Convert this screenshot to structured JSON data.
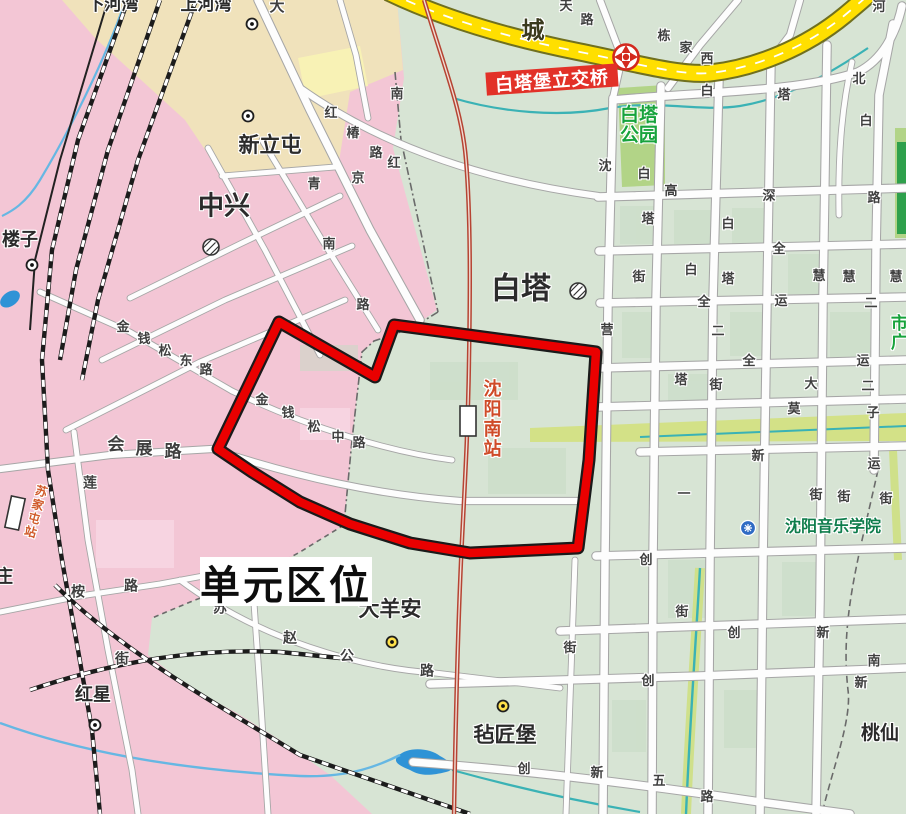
{
  "map_title": "单元区位",
  "unit_title": {
    "text": "单元区位"
  },
  "interchange_label": {
    "text": "白塔堡立交桥"
  },
  "colors": {
    "unit_boundary_red": "#ea0000",
    "boundary_casing": "#1a1a1a",
    "urban_pink": "#f3c6d5",
    "village_cream": "#f0e2bb",
    "pale_yellow_block": "#f8f2b5",
    "base_green": "#d7e4d4",
    "park_green": "#b2d487",
    "greenway": "#d3e187",
    "highway_yellow": "#ffdf00",
    "road_white": "#fdfdfd",
    "water_blue": "#2f93d6",
    "stream_blue": "#66b7e3",
    "canal_teal": "#3ab2b5",
    "railway_black": "#1c1c1c",
    "hsr_red": "#b64433",
    "station_text_red": "#cf4b28",
    "green_text": "#17a33c",
    "sign_red_bg": "#e23128"
  },
  "icons": [
    {
      "name": "interchange-icon",
      "meaning": "highway interchange (red pinwheel)"
    },
    {
      "name": "town-circle-icon",
      "meaning": "town/subdistrict hatched circle"
    },
    {
      "name": "village-dot-white-icon",
      "meaning": "village marker (white dot)"
    },
    {
      "name": "village-dot-yellow-icon",
      "meaning": "village marker (yellow dot)"
    },
    {
      "name": "college-icon",
      "meaning": "college/university marker (blue badge)"
    },
    {
      "name": "station-rect-icon",
      "meaning": "railway station"
    }
  ],
  "stations": [
    {
      "label": "沈阳南站"
    },
    {
      "label": "苏家屯站"
    }
  ],
  "labels": [
    {
      "t": "下河湾",
      "x": 113,
      "y": 5,
      "s": 17,
      "b": 1,
      "n": "place-label"
    },
    {
      "t": "上河湾",
      "x": 206,
      "y": 5,
      "s": 17,
      "b": 1,
      "n": "place-label"
    },
    {
      "t": "大",
      "x": 277,
      "y": 7,
      "s": 15,
      "n": "road-char"
    },
    {
      "t": "城",
      "x": 533,
      "y": 30,
      "s": 23,
      "b": 1,
      "c": "#3a3a1e",
      "n": "road-char"
    },
    {
      "t": "天",
      "x": 566,
      "y": 6,
      "n": "road-char"
    },
    {
      "t": "路",
      "x": 587,
      "y": 20,
      "n": "road-char"
    },
    {
      "t": "栋",
      "x": 664,
      "y": 36,
      "n": "road-char"
    },
    {
      "t": "家",
      "x": 686,
      "y": 48,
      "n": "road-char"
    },
    {
      "t": "西",
      "x": 707,
      "y": 59,
      "n": "road-char"
    },
    {
      "t": "河",
      "x": 879,
      "y": 7,
      "n": "road-char"
    },
    {
      "t": "白",
      "x": 707,
      "y": 91,
      "n": "road-char"
    },
    {
      "t": "塔",
      "x": 784,
      "y": 95,
      "n": "road-char"
    },
    {
      "t": "北",
      "x": 859,
      "y": 79,
      "n": "road-char"
    },
    {
      "t": "白",
      "x": 866,
      "y": 121,
      "n": "road-char"
    },
    {
      "t": "南",
      "x": 397,
      "y": 94,
      "n": "road-char"
    },
    {
      "t": "新立屯",
      "x": 270,
      "y": 146,
      "s": 21,
      "b": 1,
      "n": "place-label"
    },
    {
      "t": "红",
      "x": 331,
      "y": 113,
      "n": "road-char"
    },
    {
      "t": "椿",
      "x": 353,
      "y": 133,
      "n": "road-char"
    },
    {
      "t": "路",
      "x": 376,
      "y": 153,
      "n": "road-char"
    },
    {
      "t": "红",
      "x": 394,
      "y": 163,
      "n": "road-char"
    },
    {
      "t": "青",
      "x": 314,
      "y": 184,
      "n": "road-char"
    },
    {
      "t": "京",
      "x": 358,
      "y": 178,
      "n": "road-char"
    },
    {
      "t": "中兴",
      "x": 224,
      "y": 206,
      "s": 26,
      "b": 1,
      "n": "place-label"
    },
    {
      "t": "南",
      "x": 329,
      "y": 244,
      "n": "road-char"
    },
    {
      "t": "路",
      "x": 363,
      "y": 305,
      "n": "road-char"
    },
    {
      "t": "沈",
      "x": 605,
      "y": 166,
      "n": "road-char"
    },
    {
      "t": "白",
      "x": 644,
      "y": 174,
      "n": "road-char"
    },
    {
      "t": "高",
      "x": 671,
      "y": 191,
      "n": "road-char"
    },
    {
      "t": "深",
      "x": 769,
      "y": 196,
      "n": "road-char"
    },
    {
      "t": "路",
      "x": 874,
      "y": 198,
      "n": "road-char"
    },
    {
      "t": "塔",
      "x": 648,
      "y": 219,
      "n": "road-char"
    },
    {
      "t": "白",
      "x": 728,
      "y": 224,
      "n": "road-char"
    },
    {
      "t": "全",
      "x": 779,
      "y": 249,
      "n": "road-char"
    },
    {
      "t": "街",
      "x": 639,
      "y": 277,
      "n": "road-char"
    },
    {
      "t": "白",
      "x": 691,
      "y": 270,
      "n": "road-char"
    },
    {
      "t": "塔",
      "x": 728,
      "y": 279,
      "n": "road-char"
    },
    {
      "t": "慧",
      "x": 819,
      "y": 276,
      "n": "road-char"
    },
    {
      "t": "慧",
      "x": 849,
      "y": 277,
      "n": "road-char"
    },
    {
      "t": "慧",
      "x": 896,
      "y": 277,
      "n": "road-char"
    },
    {
      "t": "白塔",
      "x": 521,
      "y": 289,
      "s": 30,
      "b": 1,
      "n": "place-label"
    },
    {
      "t": "全",
      "x": 704,
      "y": 302,
      "n": "road-char"
    },
    {
      "t": "运",
      "x": 781,
      "y": 301,
      "n": "road-char"
    },
    {
      "t": "二",
      "x": 871,
      "y": 303,
      "n": "road-char"
    },
    {
      "t": "营",
      "x": 607,
      "y": 330,
      "n": "road-char"
    },
    {
      "t": "二",
      "x": 718,
      "y": 331,
      "n": "road-char"
    },
    {
      "t": "全",
      "x": 749,
      "y": 361,
      "n": "road-char"
    },
    {
      "t": "运",
      "x": 863,
      "y": 361,
      "n": "road-char"
    },
    {
      "t": "金",
      "x": 123,
      "y": 327,
      "n": "road-char"
    },
    {
      "t": "钱",
      "x": 144,
      "y": 339,
      "n": "road-char"
    },
    {
      "t": "松",
      "x": 165,
      "y": 351,
      "n": "road-char"
    },
    {
      "t": "东",
      "x": 186,
      "y": 361,
      "n": "road-char"
    },
    {
      "t": "路",
      "x": 206,
      "y": 370,
      "n": "road-char"
    },
    {
      "t": "塔",
      "x": 681,
      "y": 380,
      "n": "road-char"
    },
    {
      "t": "街",
      "x": 716,
      "y": 385,
      "n": "road-char"
    },
    {
      "t": "大",
      "x": 811,
      "y": 384,
      "n": "road-char"
    },
    {
      "t": "二",
      "x": 868,
      "y": 386,
      "n": "road-char"
    },
    {
      "t": "金",
      "x": 262,
      "y": 400,
      "n": "road-char"
    },
    {
      "t": "钱",
      "x": 288,
      "y": 413,
      "n": "road-char"
    },
    {
      "t": "松",
      "x": 314,
      "y": 427,
      "n": "road-char"
    },
    {
      "t": "中",
      "x": 338,
      "y": 437,
      "n": "road-char"
    },
    {
      "t": "路",
      "x": 359,
      "y": 443,
      "n": "road-char"
    },
    {
      "t": "莫",
      "x": 794,
      "y": 409,
      "n": "road-char"
    },
    {
      "t": "子",
      "x": 873,
      "y": 413,
      "n": "road-char"
    },
    {
      "t": "会",
      "x": 116,
      "y": 445,
      "s": 17,
      "b": 1,
      "n": "road-char"
    },
    {
      "t": "展",
      "x": 144,
      "y": 449,
      "s": 17,
      "b": 1,
      "n": "road-char"
    },
    {
      "t": "路",
      "x": 173,
      "y": 452,
      "s": 17,
      "b": 1,
      "n": "road-char"
    },
    {
      "t": "新",
      "x": 758,
      "y": 456,
      "n": "road-char"
    },
    {
      "t": "运",
      "x": 874,
      "y": 464,
      "n": "road-char"
    },
    {
      "t": "莲",
      "x": 90,
      "y": 483,
      "s": 14,
      "n": "road-char"
    },
    {
      "t": "一",
      "x": 684,
      "y": 494,
      "n": "road-char"
    },
    {
      "t": "街",
      "x": 816,
      "y": 495,
      "n": "road-char"
    },
    {
      "t": "街",
      "x": 844,
      "y": 497,
      "n": "road-char"
    },
    {
      "t": "街",
      "x": 886,
      "y": 499,
      "n": "road-char"
    },
    {
      "t": "创",
      "x": 646,
      "y": 560,
      "n": "road-char"
    },
    {
      "t": "庄",
      "x": 4,
      "y": 577,
      "s": 18,
      "b": 1,
      "n": "place-label"
    },
    {
      "t": "桉",
      "x": 78,
      "y": 592,
      "s": 14,
      "n": "road-char"
    },
    {
      "t": "路",
      "x": 131,
      "y": 586,
      "s": 14,
      "n": "road-char"
    },
    {
      "t": "苏",
      "x": 220,
      "y": 608,
      "s": 14,
      "n": "road-char"
    },
    {
      "t": "赵",
      "x": 290,
      "y": 638,
      "s": 14,
      "n": "road-char"
    },
    {
      "t": "公",
      "x": 347,
      "y": 656,
      "s": 14,
      "n": "road-char"
    },
    {
      "t": "路",
      "x": 427,
      "y": 671,
      "s": 14,
      "n": "road-char"
    },
    {
      "t": "大羊安",
      "x": 390,
      "y": 610,
      "s": 21,
      "b": 1,
      "n": "place-label"
    },
    {
      "t": "街",
      "x": 682,
      "y": 612,
      "n": "road-char"
    },
    {
      "t": "创",
      "x": 734,
      "y": 633,
      "n": "road-char"
    },
    {
      "t": "新",
      "x": 823,
      "y": 633,
      "n": "road-char"
    },
    {
      "t": "街",
      "x": 570,
      "y": 648,
      "n": "road-char"
    },
    {
      "t": "街",
      "x": 122,
      "y": 659,
      "s": 14,
      "n": "road-char"
    },
    {
      "t": "南",
      "x": 874,
      "y": 661,
      "n": "road-char"
    },
    {
      "t": "创",
      "x": 648,
      "y": 681,
      "n": "road-char"
    },
    {
      "t": "新",
      "x": 861,
      "y": 683,
      "n": "road-char"
    },
    {
      "t": "红星",
      "x": 93,
      "y": 695,
      "s": 18,
      "b": 1,
      "n": "place-label"
    },
    {
      "t": "楼子",
      "x": 20,
      "y": 240,
      "s": 18,
      "b": 1,
      "n": "place-label"
    },
    {
      "t": "毡匠堡",
      "x": 505,
      "y": 736,
      "s": 21,
      "b": 1,
      "n": "place-label"
    },
    {
      "t": "桃仙",
      "x": 880,
      "y": 734,
      "s": 19,
      "b": 1,
      "n": "place-label"
    },
    {
      "t": "创",
      "x": 524,
      "y": 769,
      "n": "road-char"
    },
    {
      "t": "新",
      "x": 597,
      "y": 773,
      "n": "road-char"
    },
    {
      "t": "五",
      "x": 659,
      "y": 781,
      "n": "road-char"
    },
    {
      "t": "路",
      "x": 707,
      "y": 797,
      "n": "road-char"
    },
    {
      "t": "沈阳南站",
      "x": 491,
      "y": 419,
      "s": 18,
      "b": 1,
      "v": 1,
      "c": "#cf4b28",
      "n": "station-name-shenyang-south"
    },
    {
      "t": "苏家屯站",
      "x": 35,
      "y": 512,
      "s": 12,
      "b": 1,
      "v": 1,
      "r": 15,
      "c": "#d05a2a",
      "n": "station-name-sujiatun"
    },
    {
      "t": "白塔公园",
      "lines": [
        "白塔",
        "公园"
      ],
      "x": 639,
      "y": 126,
      "s": 19,
      "b": 1,
      "c": "#17a33c",
      "n": "park-name-baita"
    },
    {
      "t": "市广",
      "x": 897,
      "y": 333,
      "s": 17,
      "b": 1,
      "v": 1,
      "c": "#17a33c",
      "n": "place-label-green"
    },
    {
      "t": "沈阳音乐学院",
      "x": 833,
      "y": 528,
      "s": 16,
      "b": 1,
      "c": "#0f7d4c",
      "n": "college-name"
    }
  ],
  "markers": [
    {
      "k": "dot-white",
      "x": 252,
      "y": 24
    },
    {
      "k": "dot-white",
      "x": 248,
      "y": 116
    },
    {
      "k": "dot-white",
      "x": 32,
      "y": 265
    },
    {
      "k": "dot-white",
      "x": 95,
      "y": 725
    },
    {
      "k": "dot-yellow",
      "x": 392,
      "y": 642
    },
    {
      "k": "dot-yellow",
      "x": 503,
      "y": 706
    },
    {
      "k": "town-circle",
      "x": 578,
      "y": 291
    },
    {
      "k": "town-circle",
      "x": 211,
      "y": 247
    }
  ],
  "unit_boundary_points": "279,322 375,377 394,325 596,352 589,460 578,548 470,553 410,543 350,524 300,502 252,472 218,449"
}
